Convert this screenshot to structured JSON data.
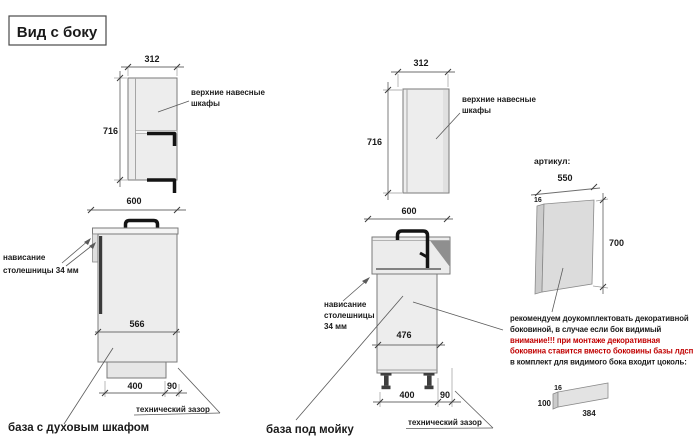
{
  "title": "Вид с боку",
  "wall1": {
    "width": "312",
    "height": "716",
    "label1": "верхние навесные",
    "label2": "шкафы"
  },
  "base_oven": {
    "width": "600",
    "depth": "566",
    "plinth_depth": "400",
    "gap": "90",
    "overhang1": "нависание",
    "overhang2": "столешницы 34 мм",
    "tech_gap": "технический зазор",
    "caption": "база с духовым шкафом"
  },
  "wall2": {
    "width": "312",
    "height": "716",
    "label1": "верхние навесные",
    "label2": "шкафы"
  },
  "base_sink": {
    "width": "600",
    "depth": "476",
    "plinth_depth": "400",
    "gap": "90",
    "overhang1": "нависание",
    "overhang2": "столешницы",
    "overhang3": "34 мм",
    "tech_gap": "технический зазор",
    "caption": "база под мойку"
  },
  "panel": {
    "header": "артикул:",
    "width": "550",
    "thickness": "16",
    "height": "700"
  },
  "plinth": {
    "thickness": "16",
    "height": "100",
    "length": "384"
  },
  "note": {
    "line1": "рекомендуем доукомплектовать декоративной",
    "line2": "боковиной, в случае если бок видимый",
    "line3": "внимание!!! при монтаже декоративная",
    "line4": "боковина ставится вместо боковины базы лдсп",
    "line5": "в комплект для видимого бока входит цоколь:"
  },
  "colors": {
    "warning_red": "#c00000",
    "ink": "#1a1a1a",
    "outline": "#7a7a7a",
    "cabinet_fill": "#ededed",
    "dark_accent": "#141414",
    "shade_gray": "#8f8f8f"
  }
}
